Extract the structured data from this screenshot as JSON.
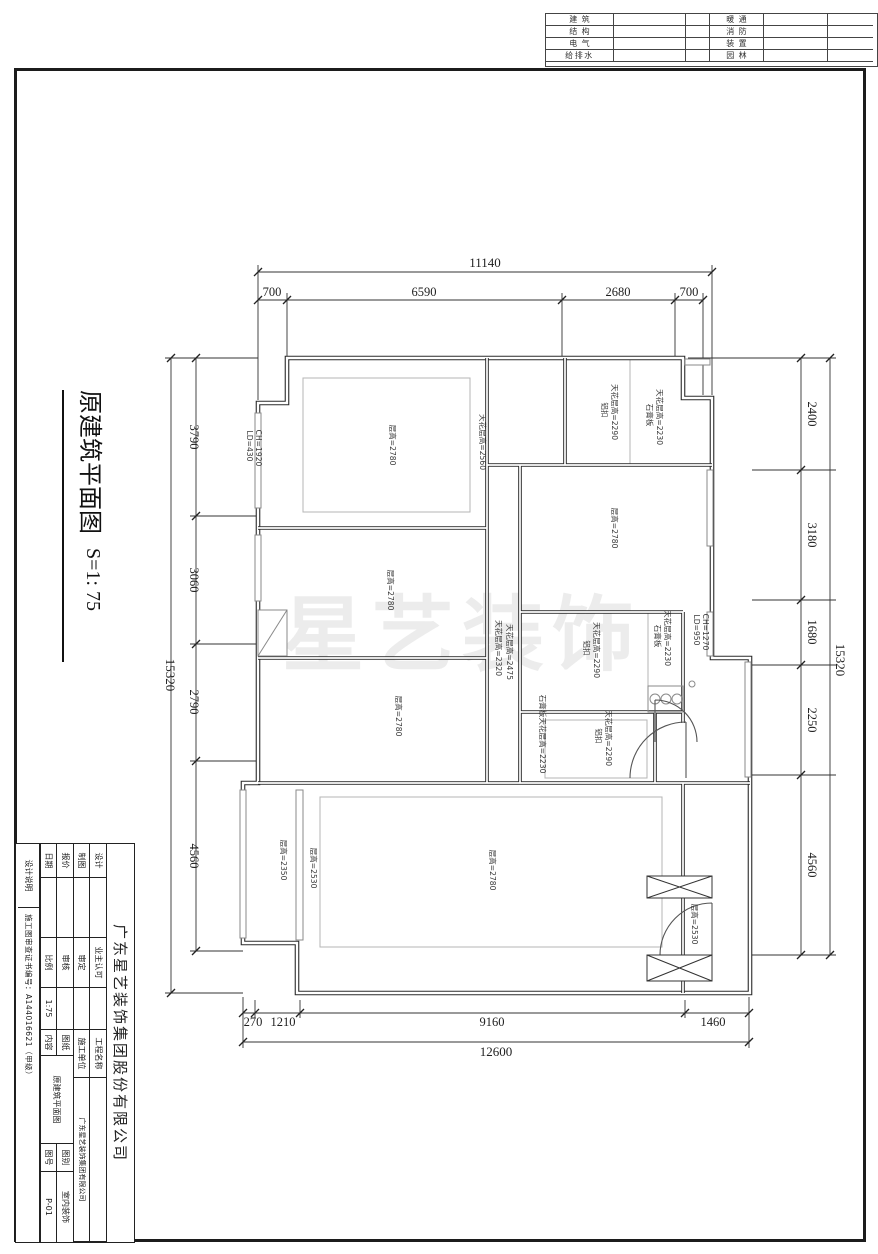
{
  "header": {
    "disciplines_left": [
      "建筑",
      "结构",
      "电气",
      "给排水"
    ],
    "disciplines_right": [
      "暖通",
      "消防",
      "装置",
      "园林"
    ]
  },
  "title": {
    "text": "原建筑平面图",
    "scale": "S=1: 75"
  },
  "watermark": "星艺装饰",
  "plan": {
    "dims": {
      "top": {
        "overall": "11140",
        "segments": [
          "700",
          "6590",
          "2680",
          "700"
        ]
      },
      "bottom": {
        "overall": "12600",
        "segments": [
          "270",
          "1210",
          "9160",
          "1460"
        ]
      },
      "left": {
        "overall": "15320",
        "segments": [
          "3790",
          "3060",
          "2790",
          "4560"
        ]
      },
      "right": {
        "overall": "15320",
        "segments": [
          "2400",
          "3180",
          "1680",
          "2250",
          "4560"
        ]
      }
    },
    "labels": {
      "bedroom1": "层高=2780",
      "bedroom1_ceiling": "天花层高=2560",
      "bath1_al": "铝扣",
      "bath1_al_h": "天花层高=2290",
      "bath1_gyp": "石膏板",
      "bath1_gyp_h": "天花层高=2230",
      "kitchen": "层高=2780",
      "bedroom2": "层高=2780",
      "corridor_a": "天花层高=2320",
      "corridor_b": "天花层高=2475",
      "bath2_al": "铝扣",
      "bath2_al_h": "天花层高=2290",
      "bath2_gyp": "石膏板",
      "bath2_gyp_h": "天花层高=2230",
      "bath3_gyp": "石膏板天花层高=2230",
      "bath3_al": "铝扣",
      "bath3_al_h": "天花层高=2290",
      "bedroom3": "层高=2780",
      "living": "层高=2780",
      "balcony": "层高=2350",
      "living_strip": "层高=2530",
      "entry": "层高=2530",
      "win1_a": "LD=430",
      "win1_b": "CH=1920",
      "win2_a": "LD=950",
      "win2_b": "CH=1270"
    }
  },
  "titleblock": {
    "company": "广东星艺装饰集团股份有限公司",
    "design": "设计",
    "drafting": "制图",
    "quote": "报价",
    "date": "日期",
    "owner_approval": "业主认可",
    "approved": "审定",
    "checked": "审核",
    "scale_label": "比例",
    "scale_value": "1:75",
    "project_name_label": "工程名称",
    "builder_label": "施工单位",
    "builder_value": "广东星艺装饰集团有限公司",
    "content_label_1": "图纸",
    "content_label_2": "内容",
    "content_value": "原建筑平面图",
    "category_label": "图别",
    "category_value": "室内装饰",
    "number_label": "图号",
    "number_value": "P-01",
    "design_note": "设计说明",
    "cert": "施工图审查证书编号：A144016621（甲级）"
  }
}
